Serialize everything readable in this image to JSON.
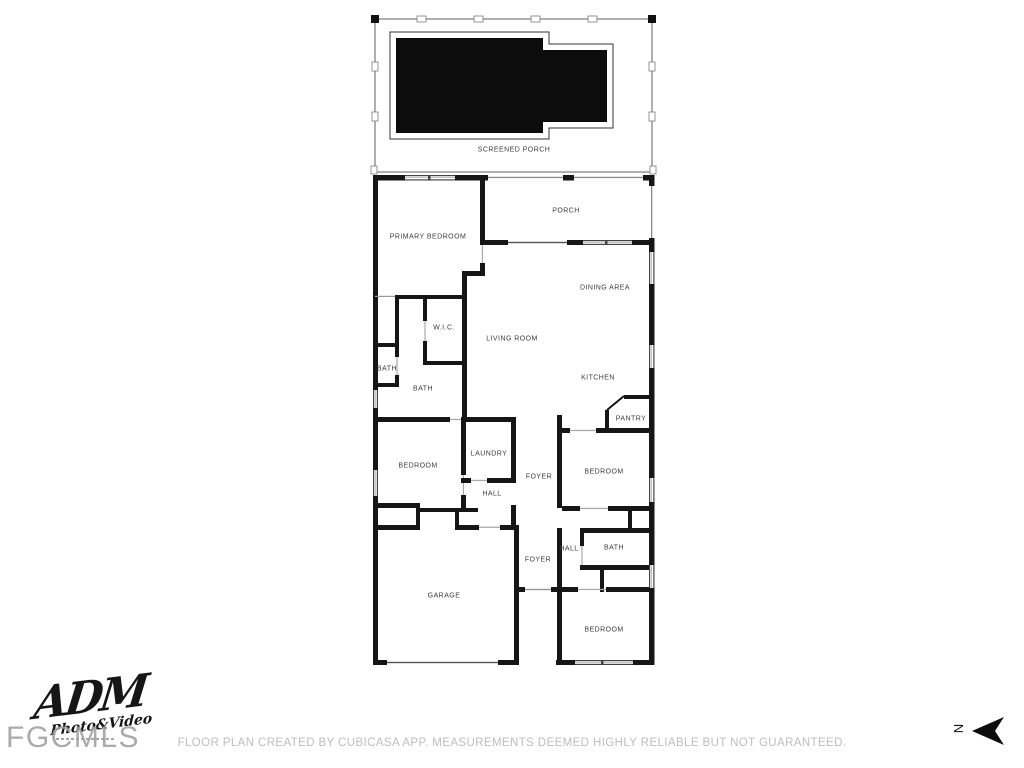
{
  "floor_plan": {
    "rooms": [
      {
        "id": "screened-porch",
        "label": "SCREENED PORCH"
      },
      {
        "id": "porch",
        "label": "PORCH"
      },
      {
        "id": "primary-bedroom",
        "label": "PRIMARY BEDROOM"
      },
      {
        "id": "dining-area",
        "label": "DINING AREA"
      },
      {
        "id": "wic",
        "label": "W.I.C."
      },
      {
        "id": "living-room",
        "label": "LIVING ROOM"
      },
      {
        "id": "bath-1",
        "label": "BATH"
      },
      {
        "id": "bath-2",
        "label": "BATH"
      },
      {
        "id": "kitchen",
        "label": "KITCHEN"
      },
      {
        "id": "pantry",
        "label": "PANTRY"
      },
      {
        "id": "laundry",
        "label": "LAUNDRY"
      },
      {
        "id": "bedroom-2",
        "label": "BEDROOM"
      },
      {
        "id": "bedroom-3",
        "label": "BEDROOM"
      },
      {
        "id": "foyer-1",
        "label": "FOYER"
      },
      {
        "id": "hall-1",
        "label": "HALL"
      },
      {
        "id": "bath-3",
        "label": "BATH"
      },
      {
        "id": "hall-2",
        "label": "HALL"
      },
      {
        "id": "foyer-2",
        "label": "FOYER"
      },
      {
        "id": "garage",
        "label": "GARAGE"
      },
      {
        "id": "bedroom-4",
        "label": "BEDROOM"
      }
    ],
    "compass": {
      "north_label": "N"
    },
    "disclaimer": "FLOOR PLAN CREATED BY CUBICASA APP. MEASUREMENTS DEEMED HIGHLY RELIABLE BUT NOT GUARANTEED.",
    "watermarks": {
      "logo_line1": "ADM",
      "logo_line2": "Photo&Video",
      "mls": "FGCMLS"
    },
    "colors": {
      "wall": "#161616",
      "pool": "#0c0c0c",
      "label_text": "#3c3c3c",
      "disclaimer_text": "#bdbdbd",
      "watermark_gray": "#a2a2a2"
    }
  }
}
